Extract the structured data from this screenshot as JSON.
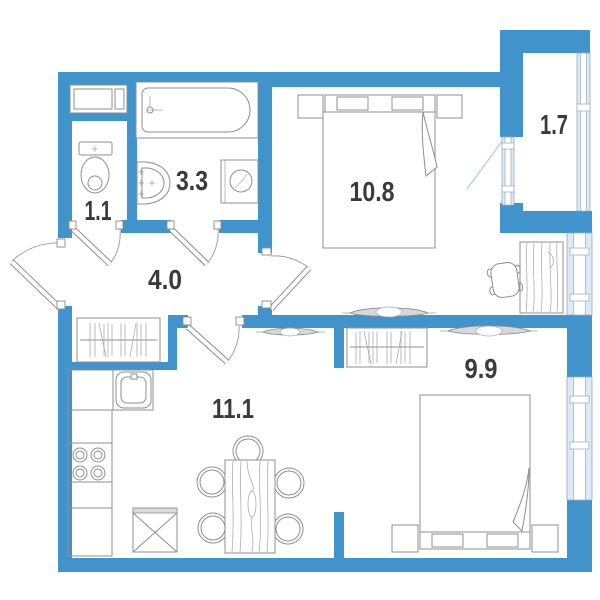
{
  "plan": {
    "rooms": {
      "wc": {
        "label": "1.1"
      },
      "bathroom": {
        "label": "3.3"
      },
      "hallway": {
        "label": "4.0"
      },
      "bedroom_top": {
        "label": "10.8"
      },
      "balcony": {
        "label": "1.7"
      },
      "kitchen_living": {
        "label": "11.1"
      },
      "bedroom_bottom": {
        "label": "9.9"
      }
    }
  },
  "colors": {
    "wall": "#4094cb",
    "window_fill": "#dcebf7",
    "frame": "#96aaba",
    "line": "#8f8f8f",
    "label": "#3a3a3a",
    "swing": "#a9cfe7"
  }
}
